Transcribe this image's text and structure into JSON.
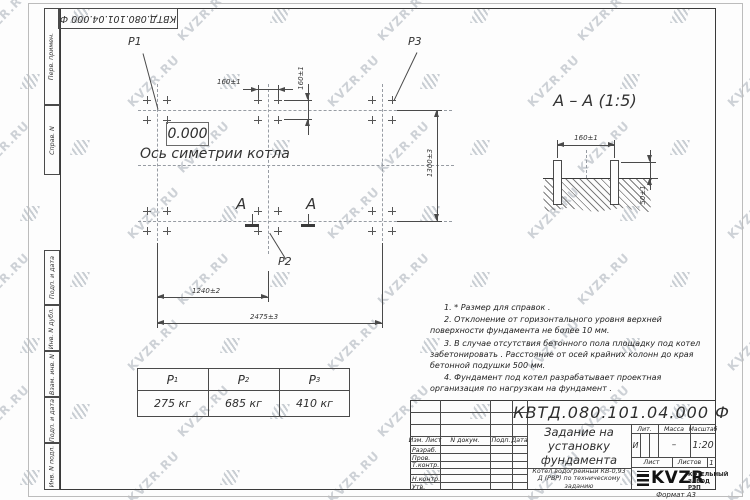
{
  "watermark": {
    "text": "KVZR.RU"
  },
  "colors": {
    "line": "#3a3a3a",
    "watermark": "#8a94a0"
  },
  "top_stamp": {
    "designation": "КВТД.080.101.04.000 Ф"
  },
  "margin_fields": [
    "Перв. примен.",
    "Справ. N",
    "Подп. и дата",
    "Инв. N дубл.",
    "Взам. инв. N",
    "Подп. и дата",
    "Инв. N подл."
  ],
  "plan": {
    "point_labels": {
      "p1": "P1",
      "p2": "P2",
      "p3": "P3"
    },
    "elevation_mark": "0.000",
    "axis_label": "Ось симетрии котла",
    "section_letter_left": "A",
    "section_letter_right": "A",
    "dimensions": {
      "bolt_spacing_horizontal": "160±1",
      "bolt_spacing_vertical": "160±1",
      "foundation_width": "1300±3",
      "left_span": "1240±2",
      "total_length": "2475±3"
    }
  },
  "section_view": {
    "title": "А – А (1:5)",
    "dimensions": {
      "bolt_spacing": "160±1",
      "bolt_protrusion": "50±1"
    }
  },
  "notes": {
    "lines": [
      "1. * Размер для справок .",
      "2. Отклонение от горизонтального уровня верхней поверхности фундамента не более 10 мм.",
      "3. В случае отсутствия бетонного пола площадку под котел забетонировать . Расстояние от осей крайних колонн до края бетонной подушки 500 мм.",
      "4. Фундамент под котел разрабатывает проектная организация по нагрузкам на фундамент ."
    ]
  },
  "load_table": {
    "headers": [
      {
        "base": "P",
        "sub": "1"
      },
      {
        "base": "P",
        "sub": "2"
      },
      {
        "base": "P",
        "sub": "3"
      }
    ],
    "values": [
      "275 кг",
      "685 кг",
      "410 кг"
    ]
  },
  "title_block": {
    "designation": "КВТД.080.101.04.000  Ф",
    "document_title": "Задание на установку фундамента",
    "product_subtitle": "Котел водогрейный КВ-0,93 Д (РВР) по техническому заданию",
    "header_row": [
      "Изм. Лист",
      "N докум.",
      "Подп.",
      "Дата"
    ],
    "left_rows": [
      "Разраб.",
      "Пров.",
      "Т.контр.",
      "Н.контр.",
      "Утв."
    ],
    "lit_label": "Лит.",
    "lit_value": "И",
    "mass_label": "Масса",
    "mass_value": "–",
    "scale_label": "Масштаб",
    "scale_value": "1:20",
    "sheet_label": "Лист",
    "sheets_label": "Листов",
    "sheets_value": "1",
    "logo_text": "KVZR",
    "company": "КОТЕЛЬНЫЙ ЗАВОД РЭП",
    "format_label": "Формат А3"
  }
}
